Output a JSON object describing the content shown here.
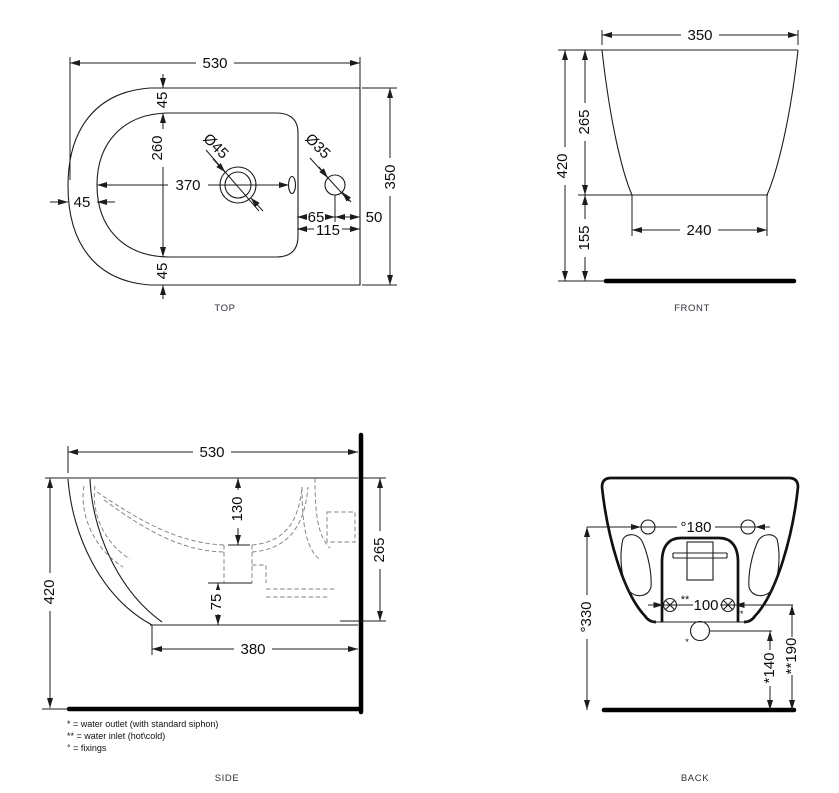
{
  "drawing": {
    "views": {
      "top": {
        "caption": "TOP",
        "dims": {
          "overall_length": "530",
          "rim_inset_top": "45",
          "inner_width": "260",
          "drain_center_from_front": "370",
          "rim_inset_front": "45",
          "rim_inset_bottom": "45",
          "overall_width": "350",
          "drain_hole_dia": "Ø45",
          "tap_hole_dia": "Ø35",
          "tap_hole_offset": "65",
          "tap_hole_to_back": "50",
          "tap_zone_width": "115"
        }
      },
      "front": {
        "caption": "FRONT",
        "dims": {
          "overall_width": "350",
          "body_height": "265",
          "mounting_height": "420",
          "base_width": "240",
          "clearance_height": "155"
        }
      },
      "side": {
        "caption": "SIDE",
        "dims": {
          "overall_length": "530",
          "mounting_height": "420",
          "rim_to_bowl_depth": "130",
          "outlet_drop": "75",
          "base_length": "380",
          "body_height": "265"
        }
      },
      "back": {
        "caption": "BACK",
        "dims": {
          "fixings_spacing": "°180",
          "fixings_height": "°330",
          "inlets_spacing": "100",
          "inlets_mark": "**",
          "inlets_sub_mark": "**",
          "outlet_mark": "*",
          "outlet_height": "*140",
          "inlets_height": "**190"
        }
      }
    },
    "legend": {
      "water_outlet": "* = water outlet (with standard siphon)",
      "water_inlet": "** = water inlet (hot\\cold)",
      "fixings": "° = fixings"
    }
  }
}
